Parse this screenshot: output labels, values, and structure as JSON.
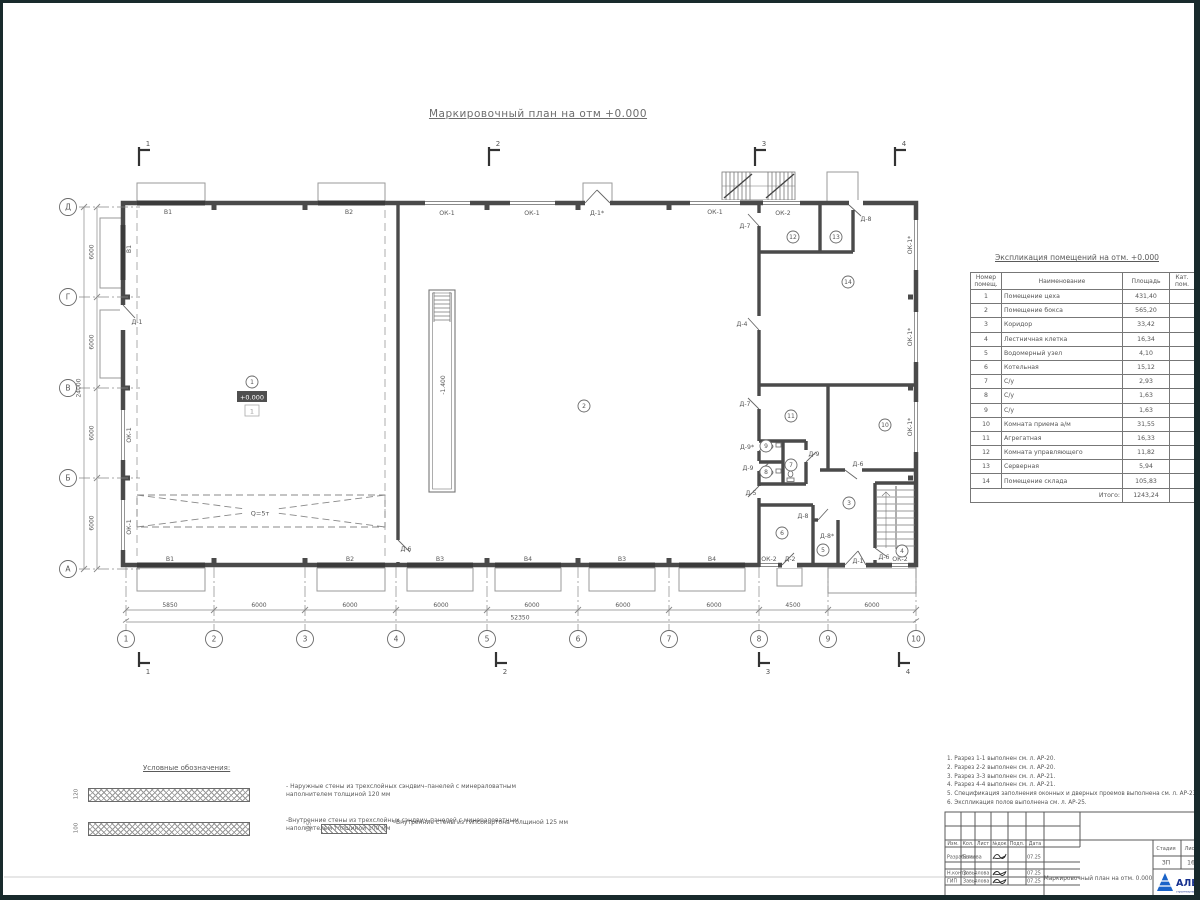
{
  "drawing": {
    "title": "Маркировочный план на отм +0.000"
  },
  "plan": {
    "grid_cols": [
      {
        "n": "1",
        "x": 126
      },
      {
        "n": "2",
        "x": 214
      },
      {
        "n": "3",
        "x": 305
      },
      {
        "n": "4",
        "x": 396
      },
      {
        "n": "5",
        "x": 487
      },
      {
        "n": "6",
        "x": 578
      },
      {
        "n": "7",
        "x": 669
      },
      {
        "n": "8",
        "x": 759
      },
      {
        "n": "9",
        "x": 828
      },
      {
        "n": "10",
        "x": 916
      }
    ],
    "grid_rows": [
      {
        "n": "Д",
        "y": 207
      },
      {
        "n": "Г",
        "y": 297
      },
      {
        "n": "В",
        "y": 388
      },
      {
        "n": "Б",
        "y": 478
      },
      {
        "n": "А",
        "y": 569
      }
    ],
    "dims_bottom": [
      {
        "t": "5850",
        "x": 170
      },
      {
        "t": "6000",
        "x": 259
      },
      {
        "t": "6000",
        "x": 350
      },
      {
        "t": "6000",
        "x": 441
      },
      {
        "t": "6000",
        "x": 532
      },
      {
        "t": "6000",
        "x": 623
      },
      {
        "t": "6000",
        "x": 714
      },
      {
        "t": "4500",
        "x": 793
      },
      {
        "t": "6000",
        "x": 872
      }
    ],
    "dim_total_bottom": {
      "t": "52350",
      "x": 520
    },
    "dims_left": [
      {
        "t": "6000",
        "y": 252
      },
      {
        "t": "6000",
        "y": 342
      },
      {
        "t": "6000",
        "y": 433
      },
      {
        "t": "6000",
        "y": 523
      }
    ],
    "dim_total_left": {
      "t": "24000",
      "y": 388
    },
    "rooms": [
      {
        "n": "1",
        "x": 252,
        "y": 382
      },
      {
        "n": "2",
        "x": 584,
        "y": 406
      },
      {
        "n": "3",
        "x": 849,
        "y": 503
      },
      {
        "n": "4",
        "x": 902,
        "y": 551
      },
      {
        "n": "5",
        "x": 823,
        "y": 550
      },
      {
        "n": "6",
        "x": 782,
        "y": 533
      },
      {
        "n": "7",
        "x": 791,
        "y": 465
      },
      {
        "n": "8",
        "x": 766,
        "y": 472
      },
      {
        "n": "9",
        "x": 766,
        "y": 446
      },
      {
        "n": "10",
        "x": 885,
        "y": 425
      },
      {
        "n": "11",
        "x": 791,
        "y": 416
      },
      {
        "n": "12",
        "x": 793,
        "y": 237
      },
      {
        "n": "13",
        "x": 836,
        "y": 237
      },
      {
        "n": "14",
        "x": 848,
        "y": 282
      }
    ],
    "openings": [
      {
        "t": "В1",
        "x": 168,
        "y": 214
      },
      {
        "t": "В2",
        "x": 349,
        "y": 214
      },
      {
        "t": "ОК-1",
        "x": 447,
        "y": 215
      },
      {
        "t": "ОК-1",
        "x": 532,
        "y": 215
      },
      {
        "t": "Д-1*",
        "x": 597,
        "y": 215
      },
      {
        "t": "ОК-1",
        "x": 715,
        "y": 214
      },
      {
        "t": "ОК-2",
        "x": 783,
        "y": 215
      },
      {
        "t": "Д-7",
        "x": 745,
        "y": 228
      },
      {
        "t": "Д-8",
        "x": 866,
        "y": 221
      },
      {
        "t": "В1",
        "x": 131,
        "y": 249,
        "r": -90
      },
      {
        "t": "Д-1",
        "x": 137,
        "y": 324
      },
      {
        "t": "ОК-1",
        "x": 131,
        "y": 435,
        "r": -90
      },
      {
        "t": "ОК-1",
        "x": 131,
        "y": 527,
        "r": -90
      },
      {
        "t": "ОК-1*",
        "x": 912,
        "y": 245,
        "r": -90
      },
      {
        "t": "ОК-1*",
        "x": 912,
        "y": 337,
        "r": -90
      },
      {
        "t": "ОК-1*",
        "x": 912,
        "y": 427,
        "r": -90
      },
      {
        "t": "В1",
        "x": 170,
        "y": 561
      },
      {
        "t": "В2",
        "x": 350,
        "y": 561
      },
      {
        "t": "В3",
        "x": 440,
        "y": 561
      },
      {
        "t": "В4",
        "x": 528,
        "y": 561
      },
      {
        "t": "В3",
        "x": 622,
        "y": 561
      },
      {
        "t": "В4",
        "x": 712,
        "y": 561
      },
      {
        "t": "ОК-2",
        "x": 769,
        "y": 561
      },
      {
        "t": "Д-2",
        "x": 790,
        "y": 561
      },
      {
        "t": "Д-1",
        "x": 858,
        "y": 563
      },
      {
        "t": "ОК-2",
        "x": 900,
        "y": 561
      },
      {
        "t": "Д-6",
        "x": 406,
        "y": 551
      },
      {
        "t": "Д-6",
        "x": 884,
        "y": 559
      },
      {
        "t": "Д-4",
        "x": 742,
        "y": 326
      },
      {
        "t": "Д-7",
        "x": 745,
        "y": 406
      },
      {
        "t": "Д-9*",
        "x": 747,
        "y": 449
      },
      {
        "t": "Д-9",
        "x": 748,
        "y": 470
      },
      {
        "t": "Д-9",
        "x": 814,
        "y": 456
      },
      {
        "t": "Д-5",
        "x": 751,
        "y": 495
      },
      {
        "t": "Д-6",
        "x": 858,
        "y": 466
      },
      {
        "t": "Д-8",
        "x": 803,
        "y": 518
      },
      {
        "t": "Д-8*",
        "x": 827,
        "y": 538
      }
    ],
    "marks": {
      "elevation": "+0.000",
      "floor_type": "1",
      "pit": "-1.400",
      "crane": "Q=5т"
    },
    "sections_top": [
      {
        "t": "1",
        "x": 146
      },
      {
        "t": "2",
        "x": 496
      },
      {
        "t": "3",
        "x": 762
      },
      {
        "t": "4",
        "x": 902
      }
    ],
    "sections_bottom": [
      {
        "t": "1",
        "x": 146
      },
      {
        "t": "2",
        "x": 503
      },
      {
        "t": "3",
        "x": 766
      },
      {
        "t": "4",
        "x": 906
      }
    ]
  },
  "schedule": {
    "title": "Экспликация помещений на отм. +0.000",
    "headers": [
      "Номер помещ.",
      "Наименование",
      "Площадь",
      "Кат. пом."
    ],
    "rows": [
      [
        "1",
        "Помещение цеха",
        "431,40"
      ],
      [
        "2",
        "Помещение бокса",
        "565,20"
      ],
      [
        "3",
        "Коридор",
        "33,42"
      ],
      [
        "4",
        "Лестничная клетка",
        "16,34"
      ],
      [
        "5",
        "Водомерный узел",
        "4,10"
      ],
      [
        "6",
        "Котельная",
        "15,12"
      ],
      [
        "7",
        "С/у",
        "2,93"
      ],
      [
        "8",
        "С/у",
        "1,63"
      ],
      [
        "9",
        "С/у",
        "1,63"
      ],
      [
        "10",
        "Комната приема а/м",
        "31,55"
      ],
      [
        "11",
        "Агрегатная",
        "16,33"
      ],
      [
        "12",
        "Комната управляющего",
        "11,82"
      ],
      [
        "13",
        "Серверная",
        "5,94"
      ],
      [
        "14",
        "Помещение склада",
        "105,83"
      ]
    ],
    "total_label": "Итого:",
    "total": "1243,24"
  },
  "legend": {
    "title": "Условные обозначения:",
    "items": [
      {
        "dim": "120",
        "text": "- Наружные стены из трехслойных сэндвич–панелей с минераловатным наполнителем толщиной 120 мм"
      },
      {
        "dim": "100",
        "text": "-Внутренние стены из трехслойных сэндвич–панелей с минераловатным наполнителем толщиной 100 мм"
      },
      {
        "dim": "125",
        "text": "–Внутренние стены из гипсокартона толщиной 125 мм"
      }
    ]
  },
  "notes": [
    "1. Разрез 1-1 выполнен см. л. АР-20.",
    "2. Разрез 2-2 выполнен см. л. АР-20.",
    "3. Разрез 3-3 выполнен см. л. АР-21.",
    "4. Разрез 4-4 выполнен см. л. АР-21.",
    "5. Спецификация заполнения оконных и дверных проемов выполнена см. л. АР-23, АР-24.",
    "6. Экспликация полов выполнена см. л. АР-25."
  ],
  "titleblock": {
    "header_cells": [
      "Изм.",
      "Кол.",
      "Лист",
      "№док",
      "Подп.",
      "Дата"
    ],
    "rows": [
      [
        "Разработал",
        "Быкова",
        "07.25"
      ],
      [
        "Н.контр",
        "Завьялова",
        "07.25"
      ],
      [
        "ГИП",
        "Завьялова",
        "07.25"
      ]
    ],
    "doc_title": "Маркировочный план на отм. 0.000",
    "stage_label": "Стадия",
    "stage": "ЗП",
    "sheet_label": "Лист",
    "sheet": "16",
    "logo_text": "АЛЬЯНС",
    "logo_sub": "строительная компания"
  }
}
